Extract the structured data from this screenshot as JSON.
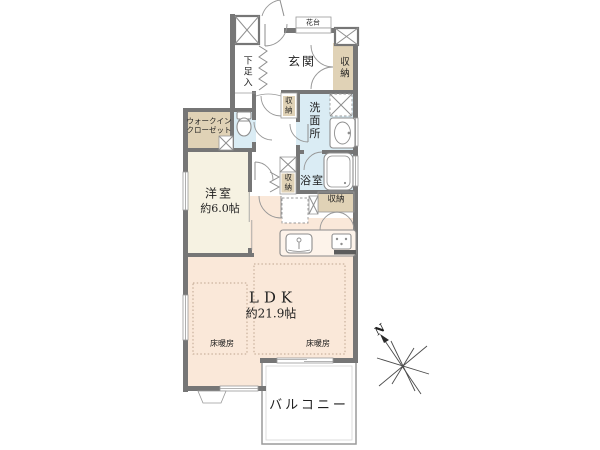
{
  "floorplan": {
    "rooms": {
      "entrance": {
        "label": "玄関"
      },
      "entrance_storage": {
        "label": "収納"
      },
      "flower_stand": {
        "label": "花台"
      },
      "shoe_cabinet": {
        "label": "下足入"
      },
      "hall_storage": {
        "label": "収納"
      },
      "washroom": {
        "label": "洗面所"
      },
      "walk_in_closet": {
        "line1": "ウォークイン",
        "line2": "クローゼット"
      },
      "western_room": {
        "label": "洋室",
        "size": "約6.0帖"
      },
      "bathroom": {
        "label": "浴室"
      },
      "hallway_storage": {
        "label": "収納"
      },
      "kitchen_storage": {
        "label": "収納"
      },
      "ldk": {
        "label": "LDK",
        "size": "約21.9帖"
      },
      "floor_heating_left": {
        "label": "床暖房"
      },
      "floor_heating_right": {
        "label": "床暖房"
      },
      "balcony": {
        "label": "バルコニー"
      }
    },
    "compass": {
      "north": "N"
    },
    "colors": {
      "wall": "#767676",
      "western_room_fill": "#f6f2e2",
      "ldk_fill": "#fae8d9",
      "storage_fill": "#e0d2b6",
      "wet_area_fill": "#daecf4",
      "heating_dash": "#bfa58f"
    }
  }
}
